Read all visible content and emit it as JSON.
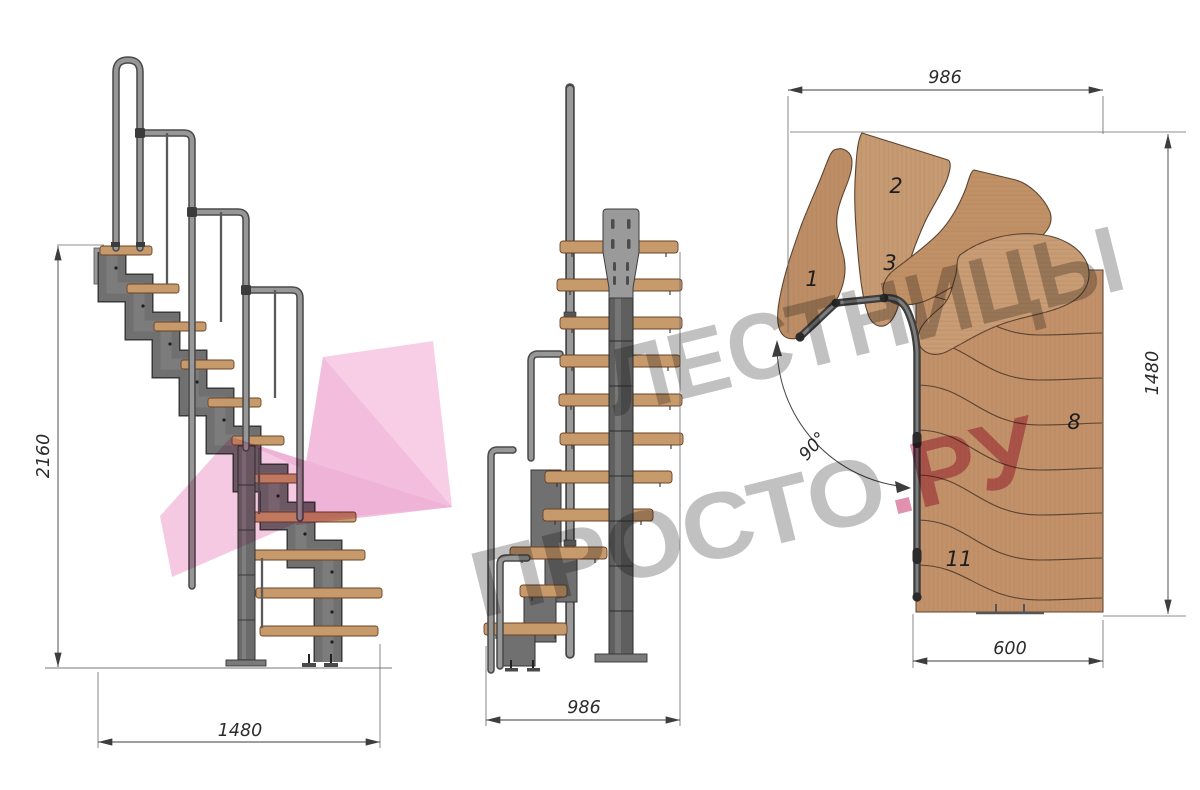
{
  "watermark": {
    "line1": "ЛЕСТНИЦЫ",
    "line2_gray": "ПРОСТО",
    "line2_accent": ".РУ",
    "text_color": "#878787",
    "accent_color": "#c22b61",
    "logo_color": "#f6c3e0"
  },
  "side_view": {
    "height_dim": "2160",
    "width_dim": "1480"
  },
  "front_view": {
    "width_dim": "986"
  },
  "plan_view": {
    "top_dim": "986",
    "right_dim": "1480",
    "bottom_dim": "600",
    "angle_label": "90°",
    "step_numbers": [
      "1",
      "2",
      "3",
      "8",
      "11"
    ]
  },
  "palette": {
    "wood_light": "#c79a6c",
    "wood_plan": "#c2916a",
    "steel": "#707070",
    "steel_dark": "#3a3a3a",
    "rail_light": "#979797",
    "rail_dark": "#4a4a4a",
    "dim_line": "#3d3d3d"
  }
}
